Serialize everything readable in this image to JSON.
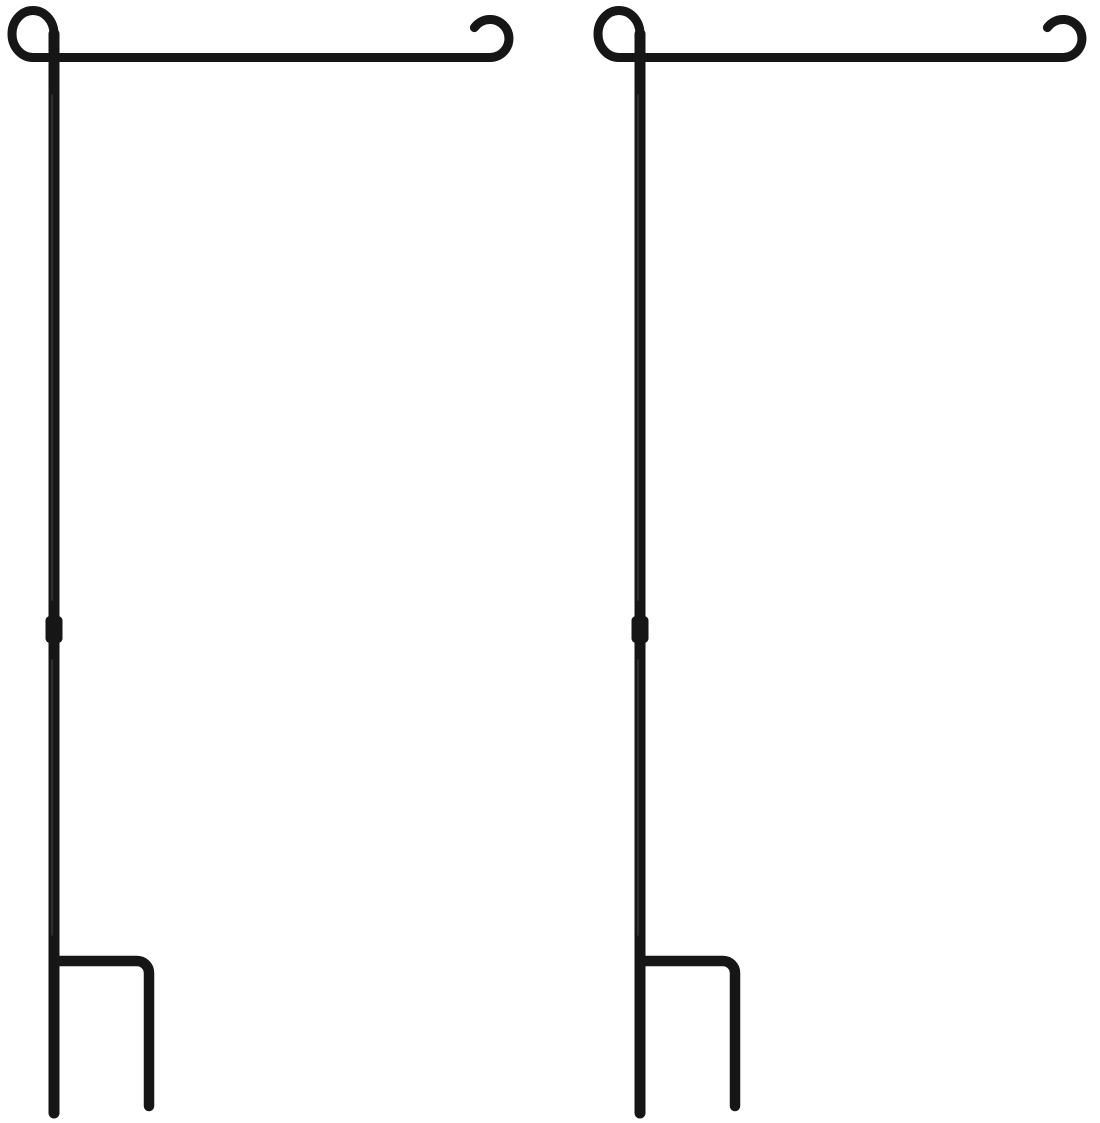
{
  "page": {
    "background_color": "#ffffff"
  },
  "product": {
    "name": "garden-flag-stand",
    "quantity_shown": 2,
    "wire_color": "#161616",
    "highlight_color": "#4a4a4a",
    "items": [
      {
        "id": "left",
        "label": "garden flag stand (left)"
      },
      {
        "id": "right",
        "label": "garden flag stand (right)"
      }
    ]
  }
}
